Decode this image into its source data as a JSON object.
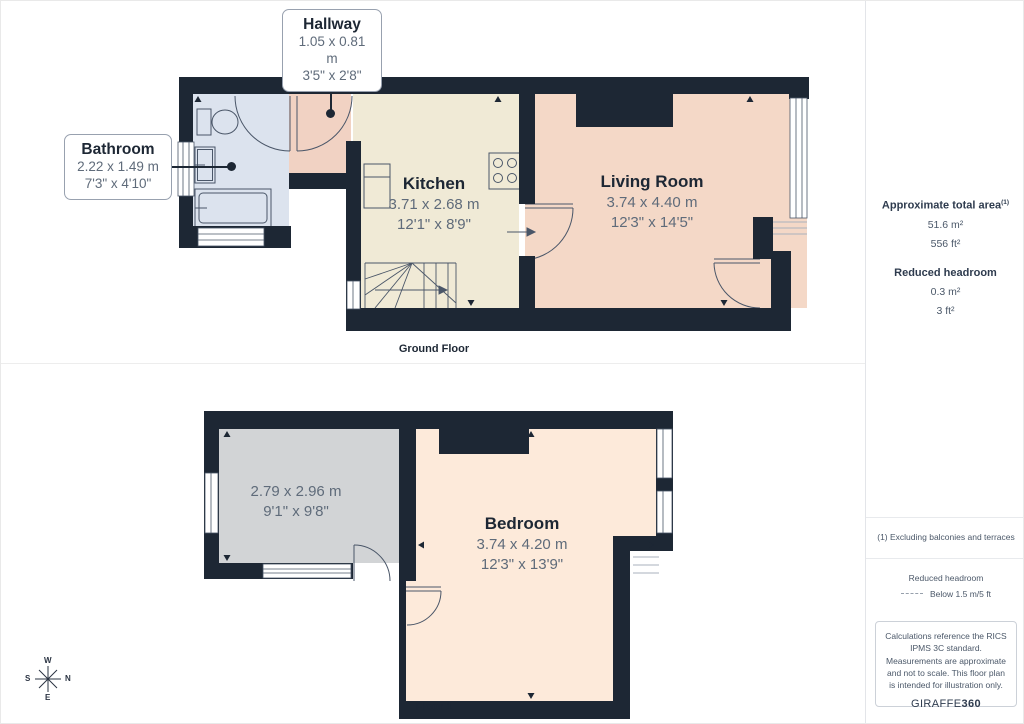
{
  "page": {
    "ground_caption": "Ground Floor",
    "first_caption": "Floor 1"
  },
  "callouts": {
    "hallway": {
      "title": "Hallway",
      "metric": "1.05 x 0.81 m",
      "imperial": "3'5\" x 2'8\""
    },
    "bathroom": {
      "title": "Bathroom",
      "metric": "2.22 x 1.49 m",
      "imperial": "7'3\" x 4'10\""
    }
  },
  "rooms": {
    "kitchen": {
      "title": "Kitchen",
      "metric": "3.71 x 2.68 m",
      "imperial": "12'1\" x 8'9\""
    },
    "living_room": {
      "title": "Living Room",
      "metric": "3.74 x 4.40 m",
      "imperial": "12'3\" x 14'5\""
    },
    "floor1_room": {
      "metric": "2.79 x 2.96 m",
      "imperial": "9'1\" x 9'8\""
    },
    "bedroom": {
      "title": "Bedroom",
      "metric": "3.74 x 4.20 m",
      "imperial": "12'3\" x 13'9\""
    }
  },
  "compass": {
    "top": "W",
    "left": "S",
    "right": "N",
    "bottom": "E"
  },
  "sidebar": {
    "total_area_label": "Approximate total area",
    "total_area_marker": "(1)",
    "total_area_metric": "51.6 m²",
    "total_area_imperial": "556 ft²",
    "headroom_label": "Reduced headroom",
    "headroom_metric": "0.3 m²",
    "headroom_imperial": "3 ft²",
    "footnote": "(1) Excluding balconies and terraces",
    "legend_label": "Reduced headroom",
    "legend_value": "Below 1.5 m/5 ft",
    "disclaimer": "Calculations reference the RICS IPMS 3C standard. Measurements are approximate and not to scale. This floor plan is intended for illustration only.",
    "brand_name": "GIRAFFE",
    "brand_suffix": "360"
  },
  "colors": {
    "wall": "#1d2734",
    "bathroom": "#dce3ee",
    "hallway": "#f1d2c3",
    "kitchen": "#f0ead6",
    "living_room": "#f4d8c7",
    "bedroom": "#fdeada",
    "floor1_room": "#d2d4d6"
  }
}
